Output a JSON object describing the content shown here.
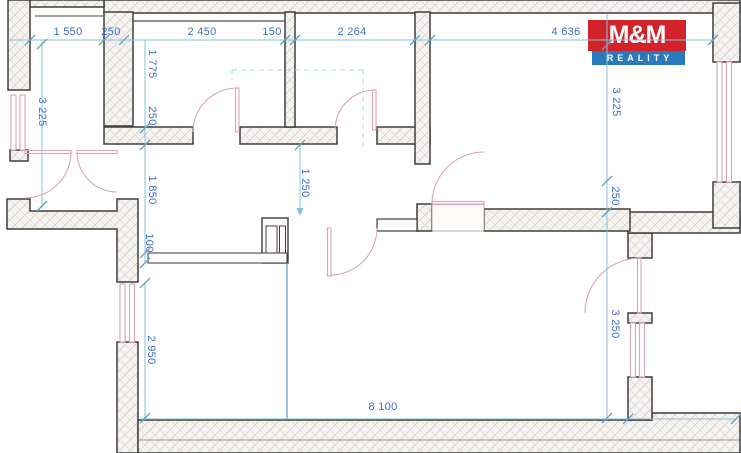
{
  "document": {
    "type": "apartment floor plan"
  },
  "logo": {
    "title": "M&M",
    "subtitle": "REALITY",
    "red": "#d2232a",
    "blue": "#2a79bb"
  },
  "dimension_labels": {
    "top_1550": "1 550",
    "top_250": "250",
    "top_2450": "2 450",
    "top_150": "150",
    "top_2264": "2 264",
    "top_4636": "4 636",
    "bottom_8100": "8 100",
    "left_3225": "3 225",
    "left_1775": "1 775",
    "left_250": "250",
    "left_1850": "1 850",
    "left_100": "100",
    "left_2950": "2 950",
    "center_1250": "1 250",
    "right_3225": "3 225",
    "right_250": "250",
    "right_3250": "3 250"
  },
  "colors": {
    "wall_outline": "#3e3e3e",
    "wall_hatch": "#d5cfc7",
    "dimension_line": "#86c3da",
    "dimension_text": "#3e6ec7",
    "window_door_pink": "#dca6af",
    "logo_red": "#d2232a",
    "logo_blue": "#2a79bb",
    "background": "#ffffff"
  }
}
